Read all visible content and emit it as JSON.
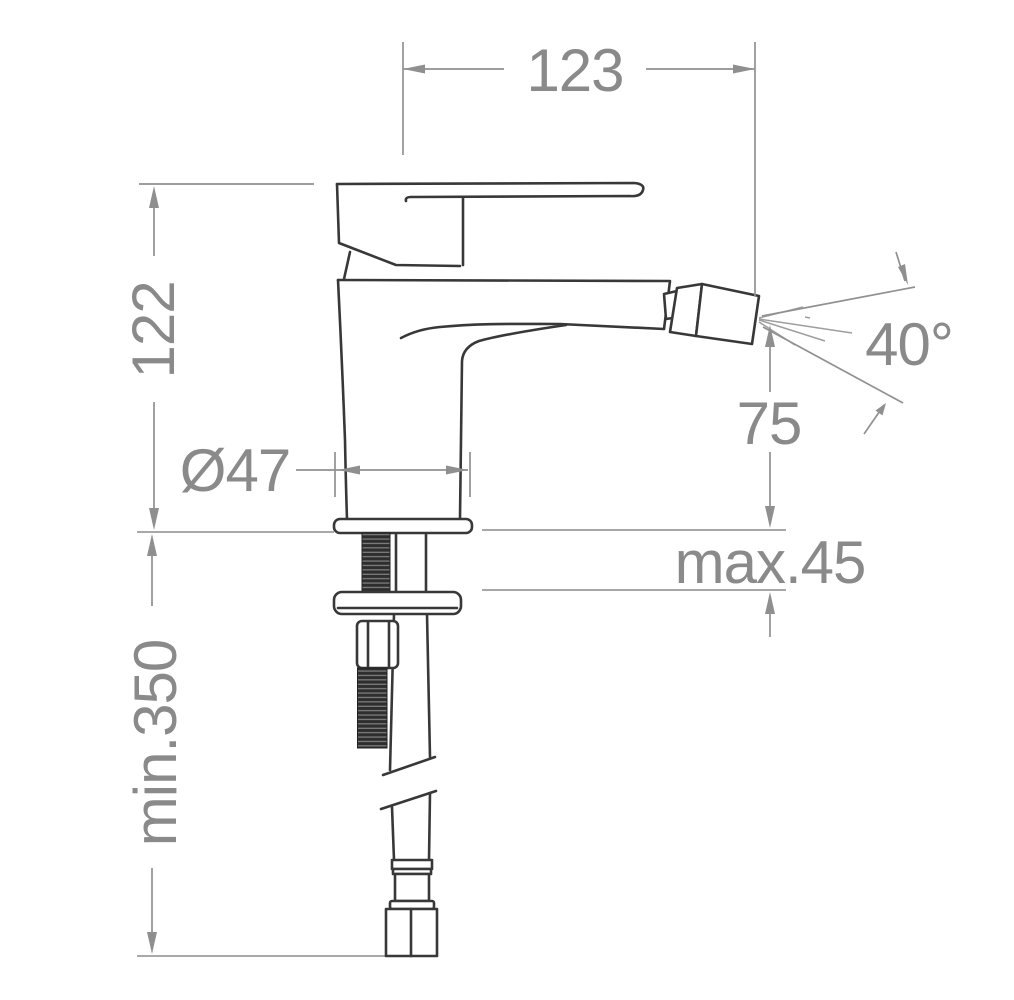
{
  "page": {
    "background": "#ffffff"
  },
  "drawing": {
    "type": "technical-dimension-drawing",
    "subject": "single-lever bidet mixer tap, side elevation with installation dimensions",
    "colors": {
      "outline": "#383838",
      "dimension_lines": "#919191",
      "dimension_text": "#8a8a8a",
      "deck_lines": "#a8a8a8",
      "thread_fill": "#2e2e2e",
      "background": "#ffffff"
    },
    "dimensions": {
      "spout_reach": {
        "label": "123"
      },
      "body_height": {
        "label": "122"
      },
      "base_diameter": {
        "label": "Ø47"
      },
      "spray_angle": {
        "label": "40°"
      },
      "spout_height": {
        "label": "75"
      },
      "max_mounting_thickness": {
        "label": "max.45"
      },
      "min_hose_length": {
        "label": "min.350"
      }
    }
  }
}
